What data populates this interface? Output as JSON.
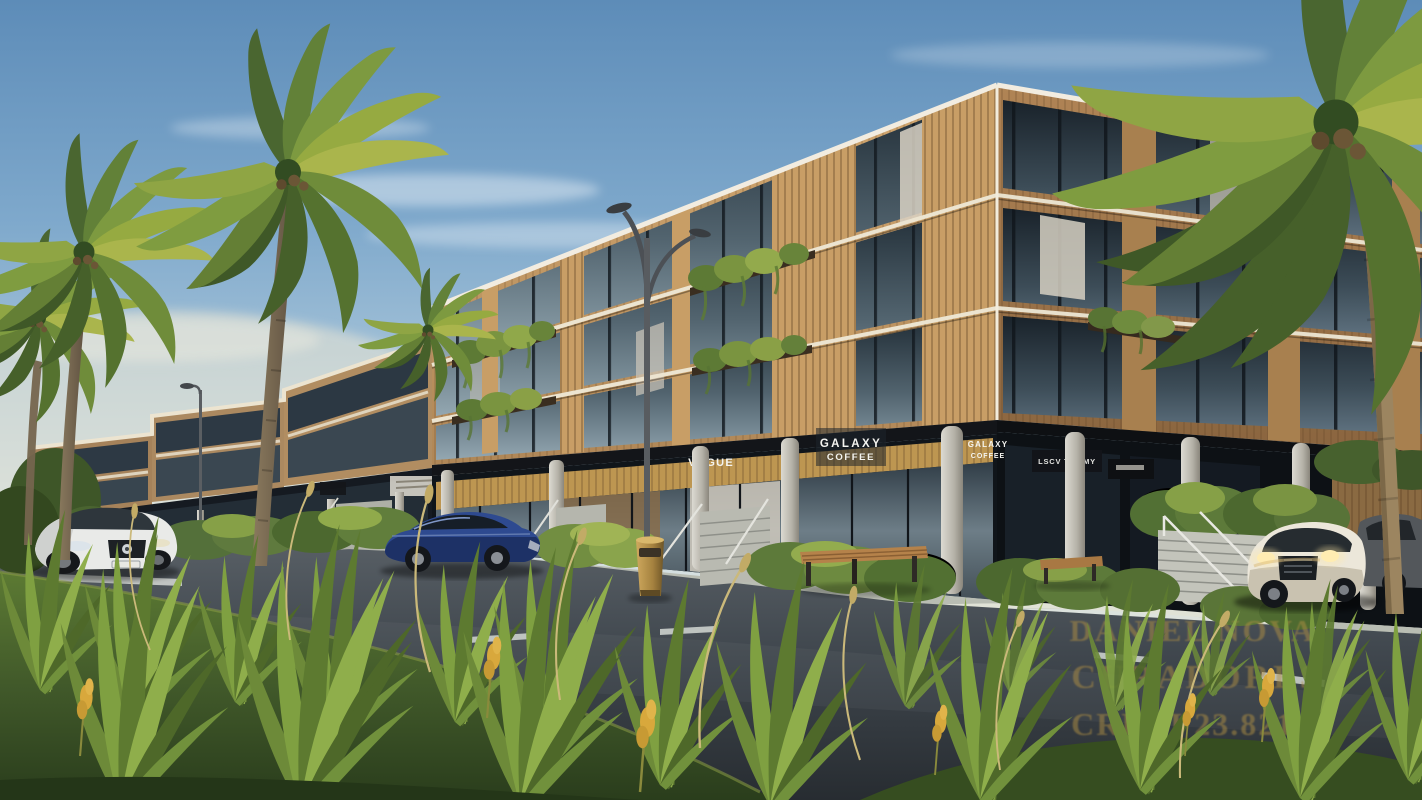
{
  "scene": {
    "watermark": {
      "line1": "DANIEL NOVA",
      "line2": "CURADORES",
      "line3": "CRECI 23.821-J",
      "color": "#b08f42"
    },
    "signs": {
      "vogue": "VOGUE",
      "galaxy_main_line1": "GALAXY",
      "galaxy_main_line2": "COFFEE",
      "galaxy_right_line1": "GALAXY",
      "galaxy_right_line2": "COFFEE",
      "boutique": "LSCV TOMMY"
    },
    "palette": {
      "sky_top": "#5d8cb8",
      "sky_horizon": "#e9e6d8",
      "wood_facade": "#c49a66",
      "wood_dark": "#9a7850",
      "glass": "#2c3b46",
      "concrete": "#c6c6be",
      "asphalt": "#3f454c",
      "grass": "#52702f",
      "watermark_gold": "#b08f42"
    }
  }
}
